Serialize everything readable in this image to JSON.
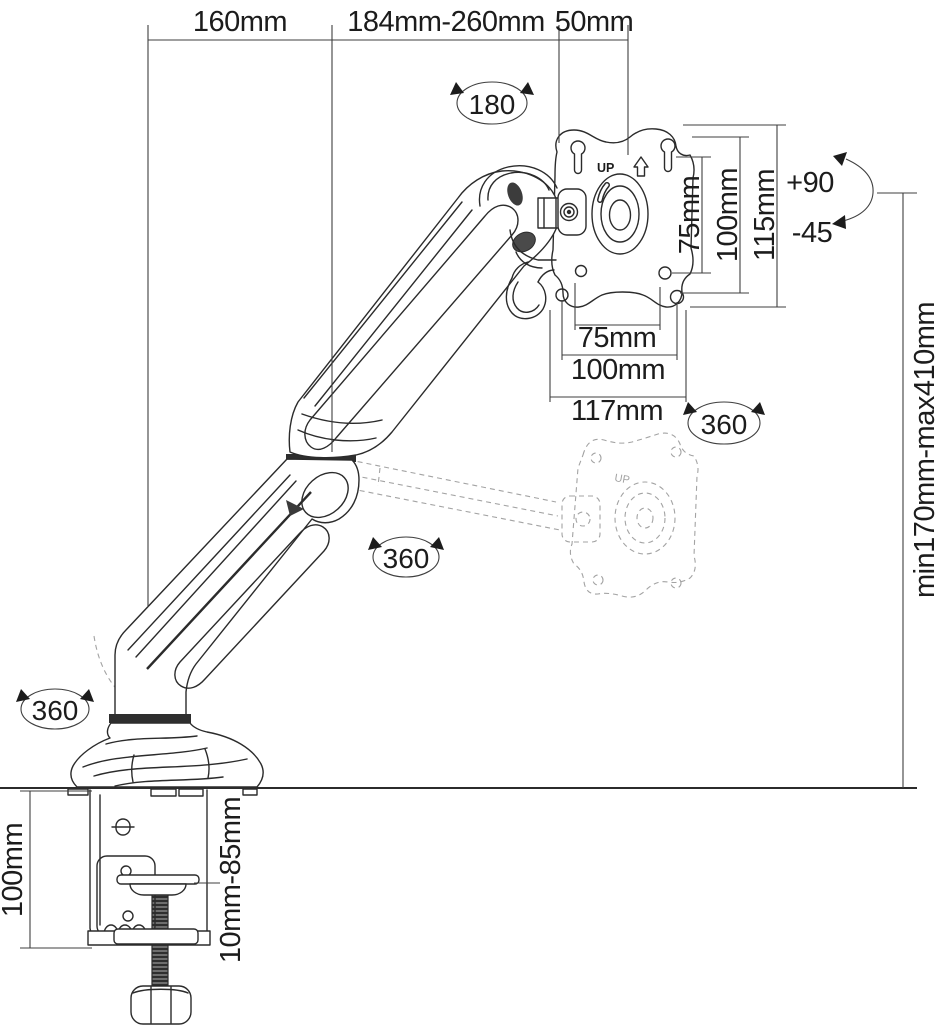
{
  "colors": {
    "ink": "#2b2b2b",
    "dim_line": "#3f3f3f",
    "ghost": "#a3a3a3",
    "background": "#ffffff"
  },
  "dimensions": {
    "top_base_to_elbow": "160mm",
    "top_elbow_to_head": "184mm-260mm",
    "top_head_offset": "50mm",
    "vesa_vertical_inner": "75mm",
    "vesa_vertical_outer": "100mm",
    "plate_height": "115mm",
    "vesa_horizontal_inner": "75mm",
    "vesa_horizontal_outer": "100mm",
    "plate_width": "117mm",
    "height_range": "min170mm-max410mm",
    "clamp_bracket_height": "100mm",
    "clamp_thickness_range": "10mm-85mm"
  },
  "rotations": {
    "head_swivel": "180",
    "vesa_rotation": "360",
    "elbow_rotation": "360",
    "base_rotation": "360",
    "tilt_up": "+90",
    "tilt_down": "-45"
  },
  "markers": {
    "plate_up": "UP",
    "ghost_plate_up": "UP"
  }
}
